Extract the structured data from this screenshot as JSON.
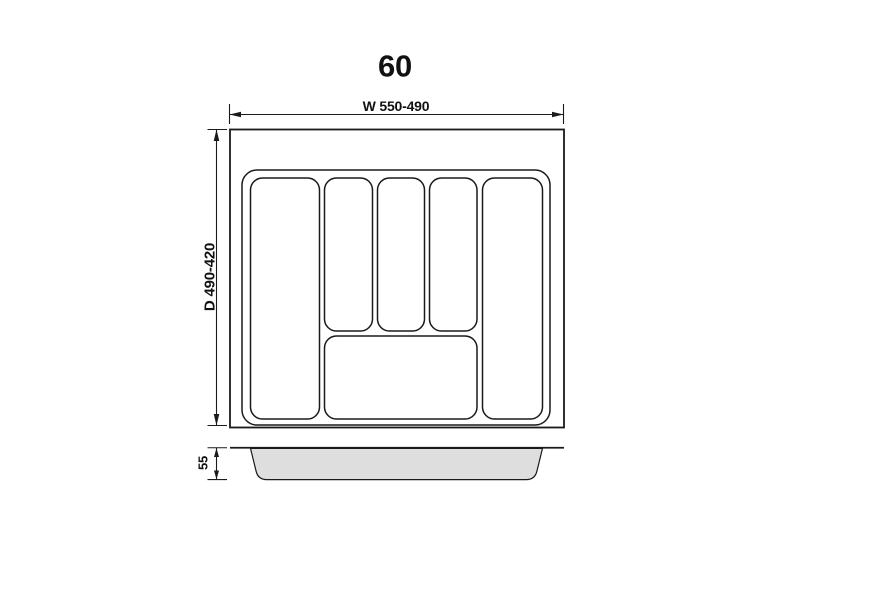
{
  "drawing": {
    "title": "60",
    "top_view": {
      "width_dimension": "W 550-490",
      "depth_dimension": "D 490-420",
      "compartments": 6
    },
    "side_view": {
      "height_label": "H",
      "height_dimension": "55"
    },
    "colors": {
      "line": "#1a1a1a",
      "tray_profile_fill": "#dedede",
      "background": "#ffffff"
    }
  }
}
